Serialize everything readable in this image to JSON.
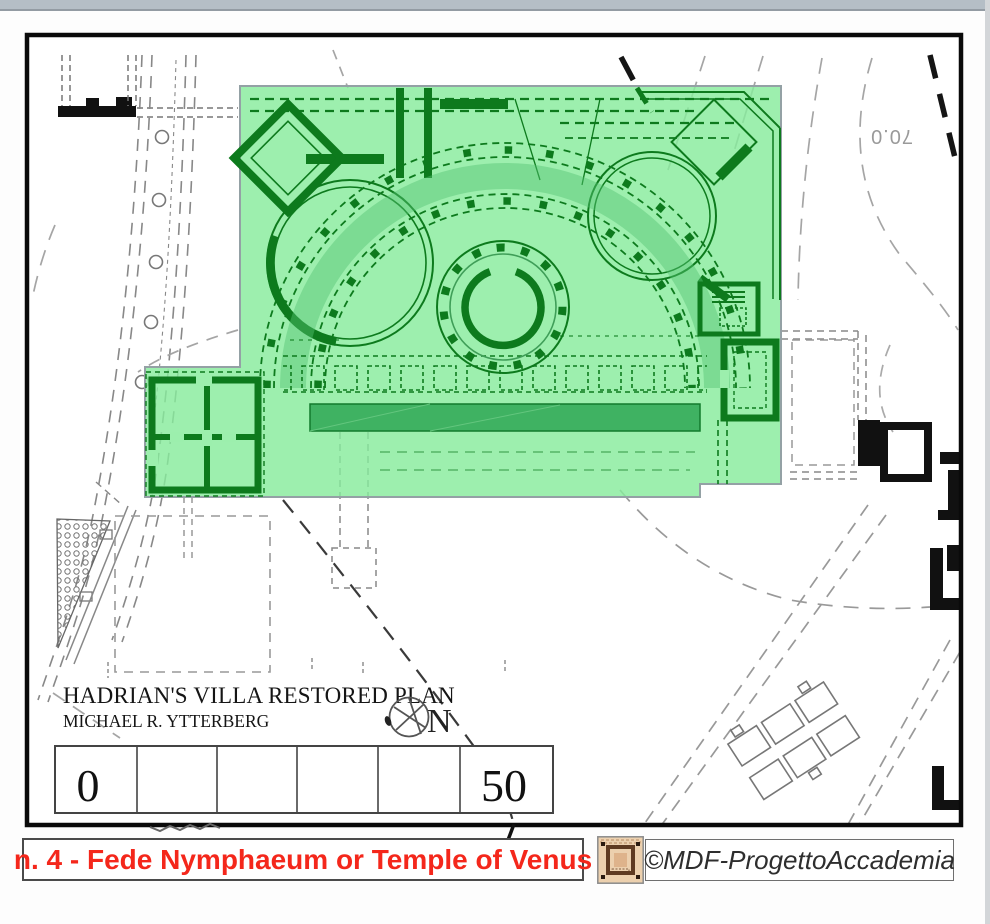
{
  "map": {
    "title": "HADRIAN'S VILLA RESTORED PLAN",
    "author": "MICHAEL R. YTTERBERG",
    "north_label": "N",
    "contour_label": "70.0",
    "scale_bar": {
      "start_label": "0",
      "end_label": "50",
      "segments": 6
    },
    "highlight_color": "#87ec9c",
    "monument_color": "#0d7a1d",
    "terrace_color": "#3fb262"
  },
  "caption": {
    "number_title": "n. 4 - Fede Nymphaeum or Temple of Venus",
    "text_color": "#f4271b"
  },
  "credit": {
    "label": "©MDF-ProgettoAccademia",
    "logo_icon": "mosaic-plan-logo-icon"
  }
}
